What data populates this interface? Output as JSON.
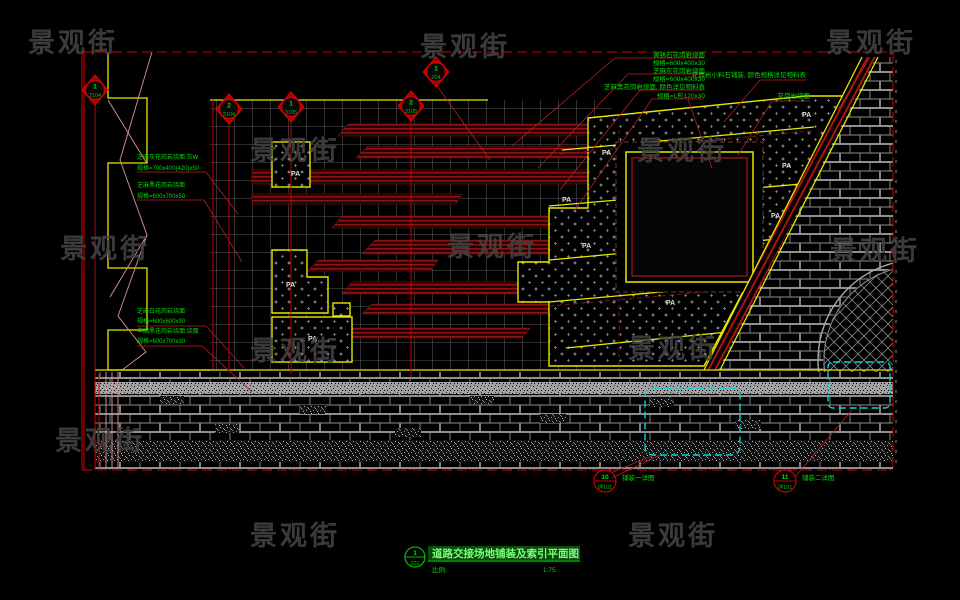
{
  "watermark": {
    "text": "景观街"
  },
  "title_block": {
    "detail_num": "1",
    "detail_ref": "201",
    "title": "道路交接场地铺装及索引平面图",
    "scale_label": "比例:",
    "scale_value": "1:75"
  },
  "markers": [
    {
      "num": "1",
      "ref": "2104"
    },
    {
      "num": "2",
      "ref": "2104"
    },
    {
      "num": "1",
      "ref": "3105"
    },
    {
      "num": "2",
      "ref": "3105"
    },
    {
      "num": "1",
      "ref": "204"
    }
  ],
  "annotations": {
    "top_right": [
      "黄锈石花岗岩烧面",
      "规格=600x400x30",
      "芝麻灰花岗岩烧面",
      "规格=600x400x30",
      "芝麻黑花岗岩烧面, 颜色详见物料表",
      "规格=L形120x30"
    ],
    "top_far_right": [
      "花岗岩小料石铺装, 颜色规格详见物料表",
      "花岗岩烧面"
    ],
    "left_group1": [
      "芝麻灰花岗岩烧面:灰W",
      "规格=700x400(420)x50"
    ],
    "left_group2": [
      "芝麻黑花岗岩烧面",
      "规格=600x700x50"
    ],
    "left_group3": [
      "芝麻白花岗岩烧面",
      "规格=600x600x30",
      "中国黑花岗岩烧面:烧面",
      "规格=600x700x30"
    ]
  },
  "callouts": [
    {
      "num": "10",
      "ref": "详101",
      "label": "铺装一详图"
    },
    {
      "num": "11",
      "ref": "详101",
      "label": "铺装二详图"
    }
  ],
  "pa_label": "PA",
  "colors": {
    "background": "#000000",
    "boundary_red": "#c80000",
    "planting_yellow": "#e8e800",
    "annotation_green": "#00dc00",
    "callout_cyan": "#00d8d8",
    "stair_dark_red": "#8e1414",
    "grid_gray": "#787878"
  }
}
